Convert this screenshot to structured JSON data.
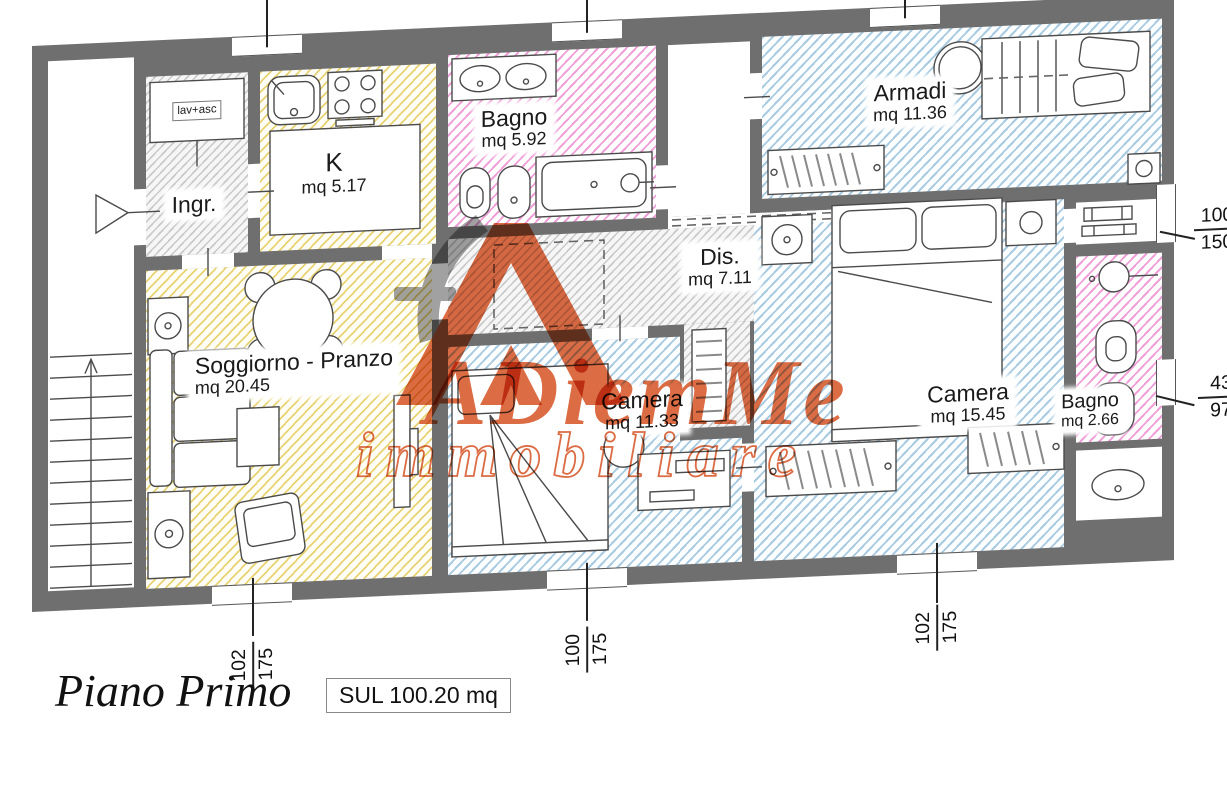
{
  "meta": {
    "floor_label": "Piano Primo",
    "sul_label": "SUL 100.20 mq"
  },
  "watermark": {
    "brand": "ADiemMe",
    "subtitle": "immobiliare"
  },
  "rooms": {
    "lav_asc": {
      "name": "lav+asc"
    },
    "ingresso": {
      "name": "Ingr."
    },
    "cucina": {
      "name": "K",
      "area": "mq 5.17"
    },
    "bagno1": {
      "name": "Bagno",
      "area": "mq 5.92"
    },
    "armadi": {
      "name": "Armadi",
      "area": "mq 11.36"
    },
    "dis": {
      "name": "Dis.",
      "area": "mq 7.11"
    },
    "soggiorno": {
      "name": "Soggiorno - Pranzo",
      "area": "mq 20.45"
    },
    "camera1": {
      "name": "Camera",
      "area": "mq 11.33"
    },
    "camera2": {
      "name": "Camera",
      "area": "mq 15.45"
    },
    "bagno2": {
      "name": "Bagno",
      "area": "mq 2.66"
    }
  },
  "dimensions": {
    "top_window_1": {
      "w": "100",
      "h": "150"
    },
    "top_window_2": {
      "w": "100",
      "h": "150"
    },
    "top_window_3": {
      "w": "100",
      "h": "150"
    },
    "right_window": {
      "w": "100",
      "h": "150"
    },
    "right_small_window": {
      "w": "43",
      "h": "97"
    },
    "bottom_window_1": {
      "w": "102",
      "h": "175"
    },
    "bottom_window_2": {
      "w": "100",
      "h": "175"
    },
    "bottom_window_3": {
      "w": "102",
      "h": "175"
    }
  },
  "colors": {
    "wall": "#6f6f6f",
    "hatch_yellow": "#e8d271",
    "hatch_pink": "#efa0d8",
    "hatch_blue": "#a9cbe2",
    "hatch_gray": "#c9c9c9",
    "brand_orange": "#d9643a",
    "brand_gray": "#9c9c9c"
  }
}
